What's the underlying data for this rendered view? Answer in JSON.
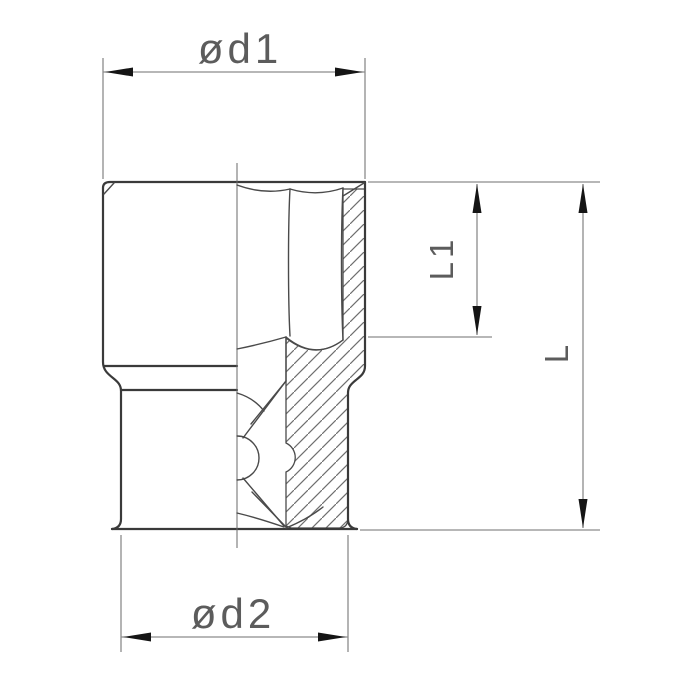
{
  "drawing": {
    "labels": {
      "d1": "ød1",
      "d2": "ød2",
      "l1": "L1",
      "l": "L"
    },
    "colors": {
      "background": "#ffffff",
      "part_outline": "#3a3a3a",
      "thin_lines": "#4a4a4a",
      "dimension_lines": "#8c8c8c",
      "arrowheads": "#151515",
      "label_text": "#5c5c5c"
    }
  }
}
